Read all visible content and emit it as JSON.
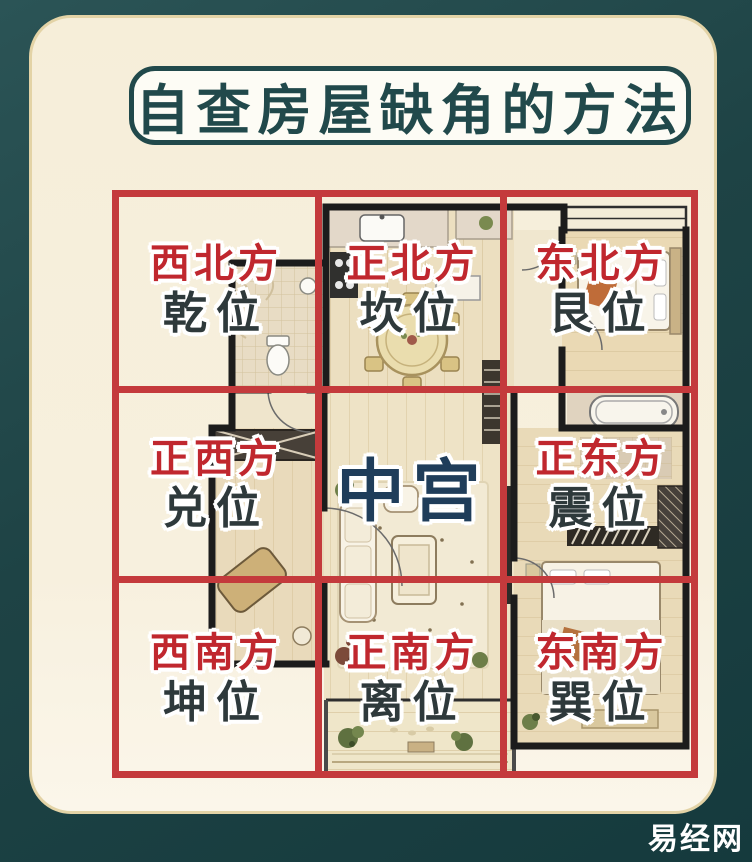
{
  "title": {
    "text": "自查房屋缺角的方法"
  },
  "watermark": {
    "text": "易经网"
  },
  "grid": {
    "cells": [
      {
        "key": "northwest",
        "direction": "西北方",
        "position": "乾位"
      },
      {
        "key": "north",
        "direction": "正北方",
        "position": "坎位"
      },
      {
        "key": "northeast",
        "direction": "东北方",
        "position": "艮位"
      },
      {
        "key": "west",
        "direction": "正西方",
        "position": "兑位"
      },
      {
        "key": "center",
        "label": "中宫"
      },
      {
        "key": "east",
        "direction": "正东方",
        "position": "震位"
      },
      {
        "key": "southwest",
        "direction": "西南方",
        "position": "坤位"
      },
      {
        "key": "south",
        "direction": "正南方",
        "position": "离位"
      },
      {
        "key": "southeast",
        "direction": "东南方",
        "position": "巽位"
      }
    ]
  },
  "colors": {
    "background_teal": "#1e4345",
    "card_cream": "#f6eed9",
    "grid_red": "#c43a3c",
    "direction_red": "#c0272e",
    "position_dark": "#2e393b",
    "center_navy": "#1f3d5a",
    "title_teal": "#21494b",
    "floorplan_wall": "#1c1c1c",
    "floorplan_floor": "#ecdfc0",
    "watermark_white": "#ffffff"
  }
}
